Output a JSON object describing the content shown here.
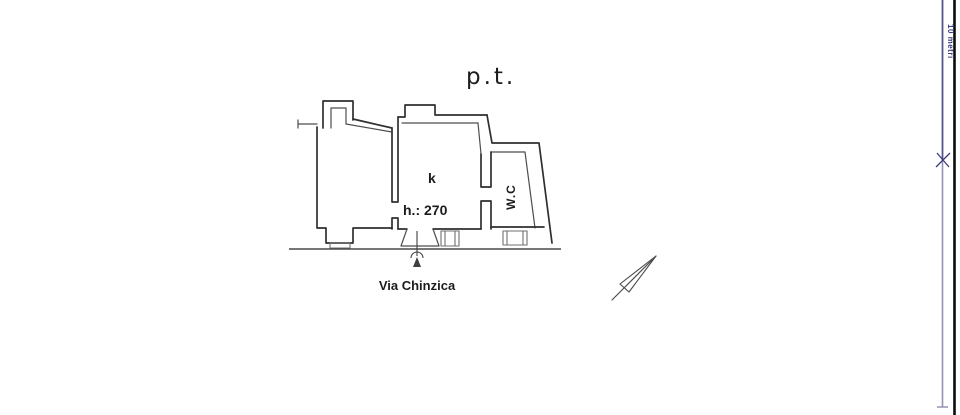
{
  "sheet": {
    "background": "#ffffff",
    "ink_color": "#2f2f2f",
    "accent_color": "#3c3c7e"
  },
  "plan": {
    "floor_label": "p.t.",
    "room_label": "k",
    "height_label": "h.: 270",
    "wc_label": "W.C",
    "street_label": "Via Chinzica"
  },
  "margin": {
    "scale_label": "10 metri"
  },
  "icons": {
    "north_arrow": "thin-triangle-pointing-north-east-with-tail-line",
    "entrance_marker": "arrow-up-with-arc-at-door",
    "scale_tick": "x-cross-on-blue-scale-line"
  }
}
